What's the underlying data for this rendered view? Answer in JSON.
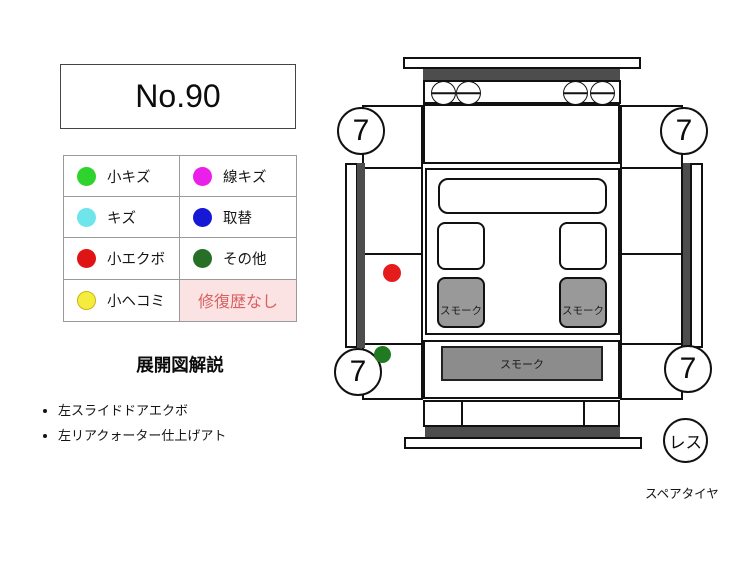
{
  "header": {
    "number_label": "No.90"
  },
  "legend": {
    "items": [
      {
        "label": "小キズ",
        "color": "#2ed32e"
      },
      {
        "label": "線キズ",
        "color": "#ea1fea"
      },
      {
        "label": "キズ",
        "color": "#6ee5ea"
      },
      {
        "label": "取替",
        "color": "#1717d6"
      },
      {
        "label": "小エクボ",
        "color": "#df1414"
      },
      {
        "label": "その他",
        "color": "#276f27"
      },
      {
        "label": "小ヘコミ",
        "color": "#f5ec3d"
      }
    ],
    "repair_status": {
      "label": "修復歴なし",
      "text_color": "#d96161",
      "bg_color": "#fbe3e3"
    }
  },
  "notes": {
    "title": "展開図解説",
    "items": [
      "左スライドドアエクボ",
      "左リアクォーター仕上げアト"
    ]
  },
  "diagram": {
    "wheel_ratings": {
      "front_left": "7",
      "front_right": "7",
      "rear_left": "7",
      "rear_right": "7"
    },
    "window_labels": {
      "left_slide": "スモーク",
      "right_slide": "スモーク",
      "rear": "スモーク"
    },
    "spare_tire": {
      "badge": "レス",
      "label": "スペアタイヤ"
    },
    "marks": [
      {
        "type": "小エクボ (左スライドドア)",
        "color": "#e51c1c"
      },
      {
        "type": "その他 (左リアクォーター)",
        "color": "#217a21"
      }
    ],
    "colors": {
      "trim": "#4d4d4d",
      "smoked_glass": "#999999",
      "rear_glass": "#8c8c8c"
    }
  }
}
